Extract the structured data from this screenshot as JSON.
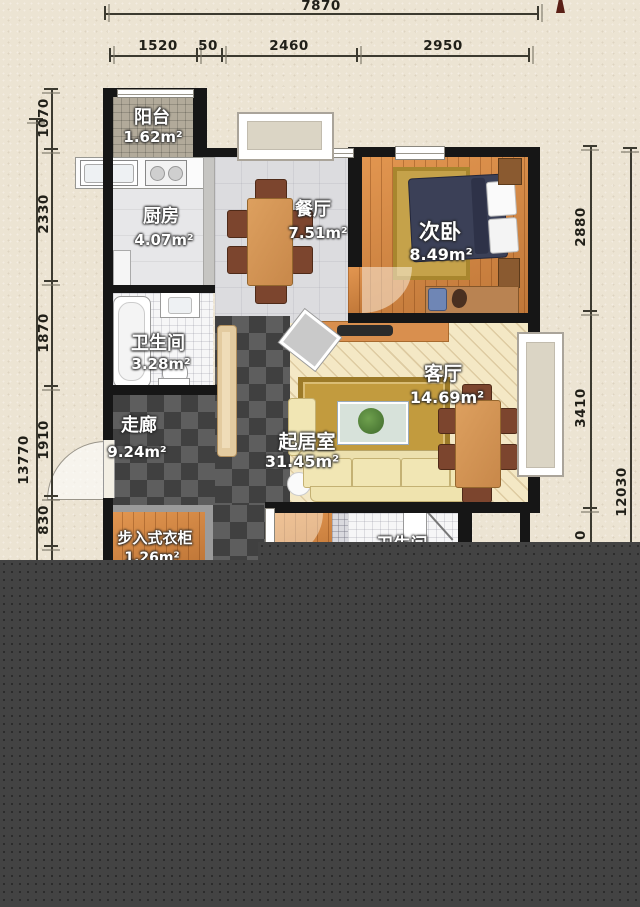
{
  "dimensions": {
    "top": {
      "overall": "7870",
      "seg1": "1520",
      "seg2": "50",
      "seg3": "2460",
      "seg4": "2950"
    },
    "left": {
      "overall": "13770",
      "seg1": "1070",
      "seg2": "2330",
      "seg3": "1870",
      "seg4": "1910",
      "seg5": "830"
    },
    "right": {
      "overall": "12030",
      "seg1": "2880",
      "seg2": "3410",
      "seg3_partial": "0"
    }
  },
  "rooms": {
    "balcony": {
      "name": "阳台",
      "area": "1.62m²"
    },
    "kitchen": {
      "name": "厨房",
      "area": "4.07m²"
    },
    "dining": {
      "name": "餐厅",
      "area": "7.51m²"
    },
    "bedroom2": {
      "name": "次卧",
      "area": "8.49m²"
    },
    "bathroom1": {
      "name": "卫生间",
      "area": "3.28m²"
    },
    "corridor": {
      "name": "走廊",
      "area": "9.24m²"
    },
    "living": {
      "name": "客厅",
      "area": "14.69m²"
    },
    "living_area": {
      "name": "起居室",
      "area": "31.45m²"
    },
    "walkin_closet": {
      "name": "步入式衣柜",
      "area": "1.26m²"
    },
    "bathroom2": {
      "name": "卫生间",
      "area": ""
    }
  }
}
